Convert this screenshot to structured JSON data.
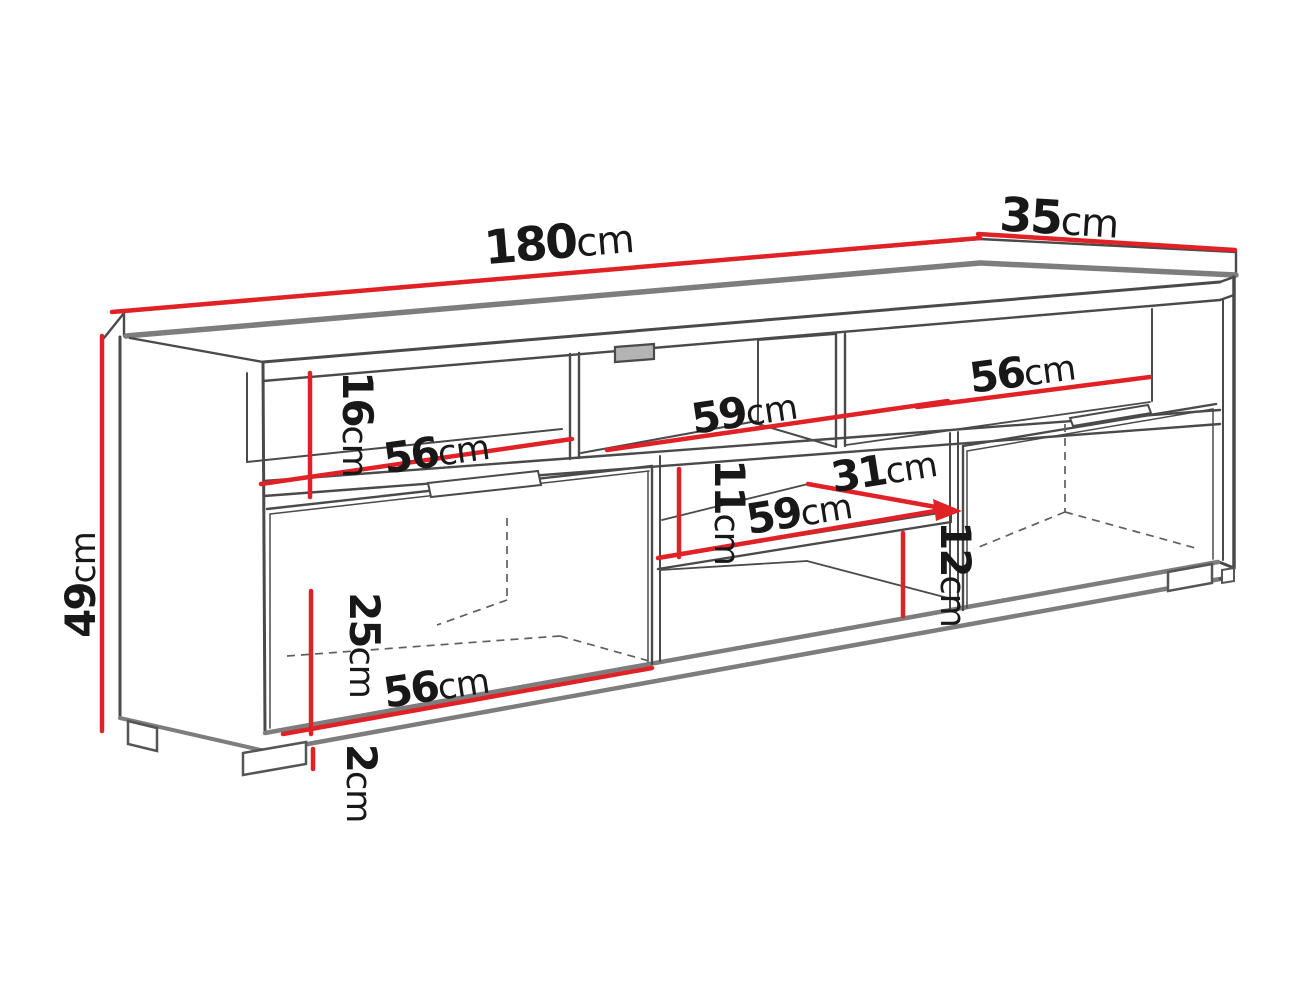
{
  "drawing": {
    "kind": "furniture-dimension-diagram",
    "unit": "cm",
    "colors": {
      "dimension_line": "#e02227",
      "linework_dark": "#4a4a4a",
      "linework_light": "#7d7d7d",
      "text": "#181818",
      "background": "#ffffff"
    },
    "labels": [
      {
        "id": "overall-width",
        "value": "180",
        "unit": "cm"
      },
      {
        "id": "overall-depth",
        "value": "35",
        "unit": "cm"
      },
      {
        "id": "overall-height",
        "value": "49",
        "unit": "cm"
      },
      {
        "id": "top-niche-height",
        "value": "16",
        "unit": "cm"
      },
      {
        "id": "top-left-niche-width",
        "value": "56",
        "unit": "cm"
      },
      {
        "id": "top-middle-niche-width",
        "value": "59",
        "unit": "cm"
      },
      {
        "id": "top-right-niche-width",
        "value": "56",
        "unit": "cm"
      },
      {
        "id": "middle-shelf-depth",
        "value": "31",
        "unit": "cm"
      },
      {
        "id": "middle-shelf-width",
        "value": "59",
        "unit": "cm"
      },
      {
        "id": "above-shelf-height",
        "value": "11",
        "unit": "cm"
      },
      {
        "id": "below-shelf-height",
        "value": "12",
        "unit": "cm"
      },
      {
        "id": "door-height",
        "value": "25",
        "unit": "cm"
      },
      {
        "id": "bottom-left-width",
        "value": "56",
        "unit": "cm"
      },
      {
        "id": "foot-height",
        "value": "2",
        "unit": "cm"
      }
    ]
  }
}
